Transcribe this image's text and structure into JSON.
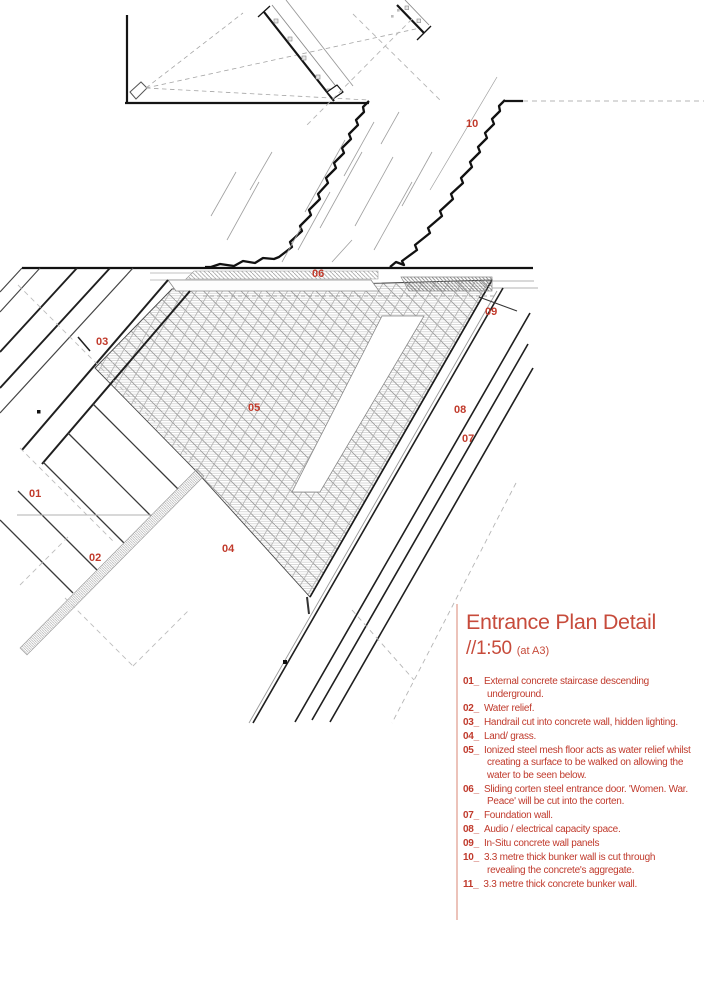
{
  "title": {
    "name": "Entrance Plan Detail",
    "scale": "//1:50",
    "scale_suffix": "(at A3)"
  },
  "colors": {
    "accent_red": "#c03a2c",
    "title_red": "#c74b3b",
    "rule_pink": "#ecc3ba",
    "line_dark": "#151515",
    "line_gray": "#9a9a9a"
  },
  "plan": {
    "labels": [
      "10",
      "06",
      "09",
      "03",
      "05",
      "08",
      "07",
      "01",
      "02",
      "04"
    ]
  },
  "legend": {
    "items": [
      {
        "num": "01_",
        "text": "External concrete staircase descending underground."
      },
      {
        "num": "02_",
        "text": "Water relief."
      },
      {
        "num": "03_",
        "text": "Handrail cut into concrete wall, hidden lighting."
      },
      {
        "num": "04_",
        "text": "Land/ grass."
      },
      {
        "num": "05_",
        "text": "Ionized steel mesh floor acts as water relief whilst creating a surface to be walked on allowing the water to be seen below."
      },
      {
        "num": "06_",
        "text": "Sliding corten steel entrance door. 'Women. War. Peace' will be cut into the corten."
      },
      {
        "num": "07_",
        "text": "Foundation wall."
      },
      {
        "num": "08_",
        "text": "Audio / electrical capacity space."
      },
      {
        "num": "09_",
        "text": "In-Situ concrete wall panels"
      },
      {
        "num": "10_",
        "text": "3.3 metre thick bunker wall is cut through revealing the concrete's aggregate."
      },
      {
        "num": "11_",
        "text": "3.3 metre thick concrete bunker wall."
      }
    ]
  }
}
